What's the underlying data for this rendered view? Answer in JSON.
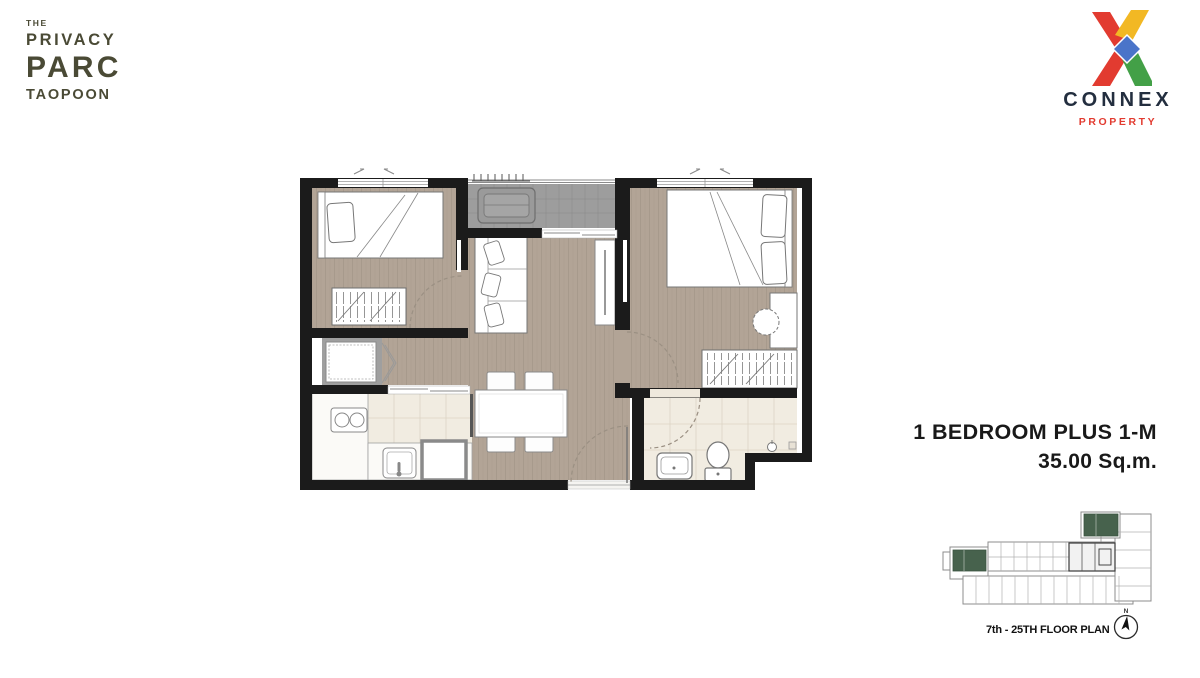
{
  "brand": {
    "the": "THE",
    "privacy": "PRIVACY",
    "parc": "PARC",
    "taopoon": "TAOPOON",
    "color": "#4a4a35"
  },
  "developer": {
    "name": "CONNEX",
    "division": "PROPERTY",
    "colors": {
      "navy": "#232e3f",
      "red": "#e23b30",
      "yellow": "#f2b824",
      "green": "#43a047",
      "blue": "#4a74c9"
    }
  },
  "unit": {
    "type": "1 BEDROOM PLUS 1-M",
    "area": "35.00 Sq.m."
  },
  "key_plan": {
    "caption": "7th - 25TH FLOOR PLAN",
    "compass": "N",
    "highlight_color": "#47624d"
  },
  "floor_plan": {
    "features": [
      "balcony",
      "ac-condenser",
      "bedroom-1",
      "single-bed",
      "wardrobe-1",
      "washing-machine",
      "kitchen",
      "stove",
      "kitchen-sink",
      "refrigerator",
      "dining-table",
      "dining-chairs",
      "sofa",
      "tv-console",
      "bedroom-2",
      "double-bed",
      "desk",
      "stool",
      "wardrobe-2",
      "bathroom",
      "basin",
      "toilet",
      "shower-valve",
      "floor-drain",
      "entrance-door"
    ],
    "colors": {
      "wall": "#1b1b1b",
      "wood_floor": "#b2a496",
      "balcony_tile": "#9d9d9d",
      "wet_room_tile": "#f1ece1",
      "fixture_outline": "#7a7a7a"
    }
  }
}
